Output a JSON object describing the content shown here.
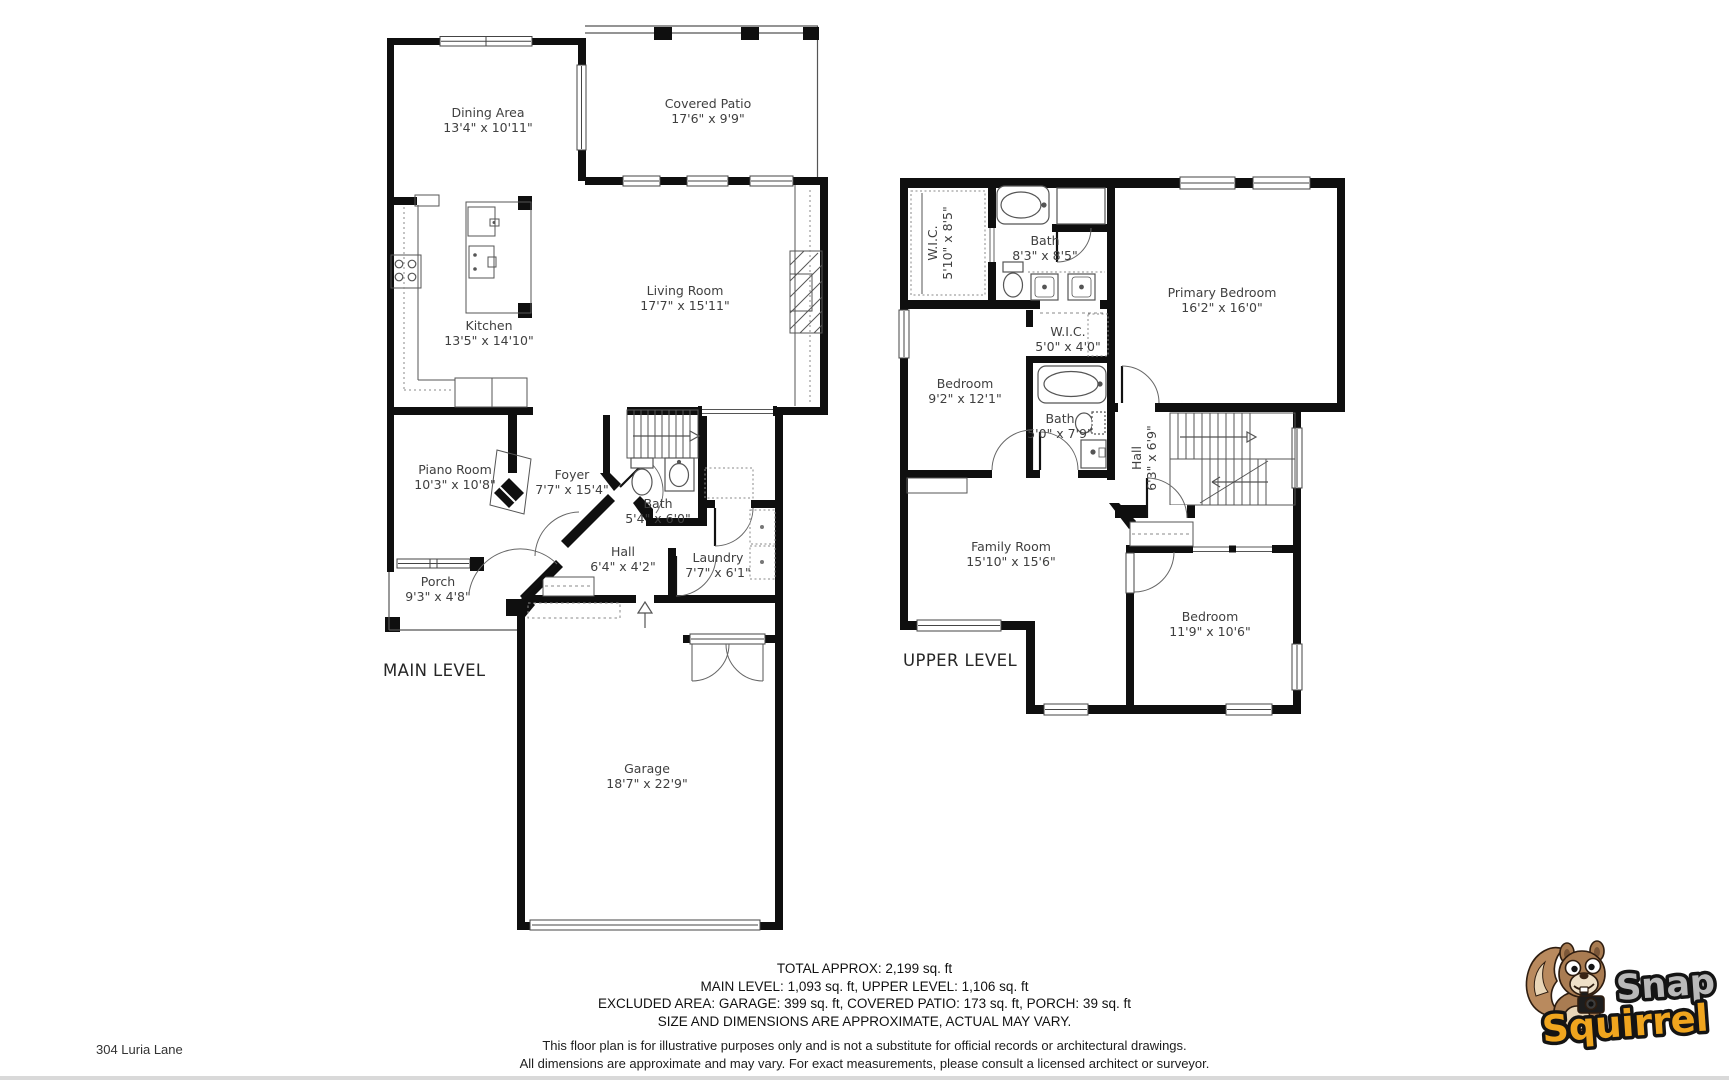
{
  "page": {
    "address": "304 Luria Lane"
  },
  "main_level": {
    "title": "MAIN LEVEL",
    "rooms": [
      {
        "name": "Dining Area",
        "dims": "13'4\" x 10'11\""
      },
      {
        "name": "Covered Patio",
        "dims": "17'6\" x 9'9\""
      },
      {
        "name": "Living Room",
        "dims": "17'7\" x 15'11\""
      },
      {
        "name": "Kitchen",
        "dims": "13'5\" x 14'10\""
      },
      {
        "name": "Piano Room",
        "dims": "10'3\" x 10'8\""
      },
      {
        "name": "Foyer",
        "dims": "7'7\" x 15'4\""
      },
      {
        "name": "Bath",
        "dims": "5'4\" x 6'0\""
      },
      {
        "name": "Hall",
        "dims": "6'4\" x 4'2\""
      },
      {
        "name": "Laundry",
        "dims": "7'7\" x 6'1\""
      },
      {
        "name": "Porch",
        "dims": "9'3\" x 4'8\""
      },
      {
        "name": "Garage",
        "dims": "18'7\" x 22'9\""
      }
    ]
  },
  "upper_level": {
    "title": "UPPER LEVEL",
    "rooms": [
      {
        "name": "W.I.C.",
        "dims": "5'10\" x 8'5\""
      },
      {
        "name": "Bath",
        "dims": "8'3\" x 8'5\""
      },
      {
        "name": "Primary Bedroom",
        "dims": "16'2\" x 16'0\""
      },
      {
        "name": "Bedroom",
        "dims": "9'2\" x 12'1\""
      },
      {
        "name": "W.I.C.",
        "dims": "5'0\" x 4'0\""
      },
      {
        "name": "Bath",
        "dims": "5'0\" x 7'9\""
      },
      {
        "name": "Hall",
        "dims": "6'3\" x 6'9\""
      },
      {
        "name": "Family Room",
        "dims": "15'10\" x 15'6\""
      },
      {
        "name": "Bedroom",
        "dims": "11'9\" x 10'6\""
      }
    ]
  },
  "summary": {
    "line1": "TOTAL APPROX: 2,199 sq. ft",
    "line2": "MAIN LEVEL: 1,093 sq. ft, UPPER LEVEL: 1,106 sq. ft",
    "line3": "EXCLUDED AREA: GARAGE: 399 sq. ft, COVERED PATIO: 173 sq. ft, PORCH: 39 sq. ft",
    "line4": "SIZE AND DIMENSIONS ARE APPROXIMATE, ACTUAL MAY VARY."
  },
  "disclaimer": {
    "line1": "This floor plan is for illustrative purposes only and is not a substitute for official records or architectural drawings.",
    "line2": "All dimensions are approximate and may vary. For exact measurements, please consult a licensed architect or surveyor."
  },
  "logo": {
    "word1": "Snap",
    "word2": "Squirrel",
    "word1_color": "#b9b9b9",
    "word2_color": "#efa51e"
  },
  "colors": {
    "wall": "#0f0f0f",
    "line": "#555555",
    "label": "#3f3f3f"
  }
}
